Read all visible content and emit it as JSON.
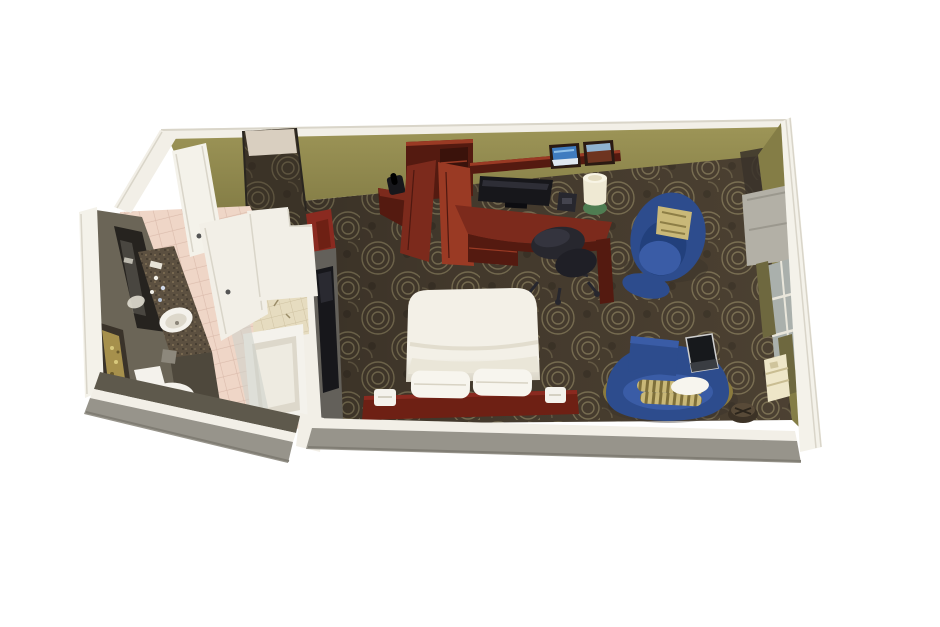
{
  "scene": {
    "title": "Hotel guest room 3D floor plan",
    "description": "Isometric cutaway dollhouse rendering of a hotel guest room with bedroom, entry vestibule and bathroom",
    "view": "top-down isometric cutaway",
    "rooms": [
      "bedroom",
      "bathroom",
      "entry-vestibule"
    ]
  },
  "inventory": {
    "bedroom": [
      "entry-door",
      "armoire-closet",
      "corner-phone-shelf",
      "telephone",
      "work-desk",
      "desk-chair",
      "flat-screen-tv",
      "wall-shelf",
      "framed-picture-beach",
      "framed-picture-landscape",
      "table-lamp",
      "alarm-clock",
      "queen-bed",
      "bed-pillows",
      "headboard",
      "bedside-sconces",
      "tub-armchair",
      "accent-pillow",
      "curved-sofa",
      "bolster-pillows",
      "laptop",
      "round-side-table",
      "window-with-curtains",
      "valance",
      "ptac-air-conditioner",
      "patterned-carpet",
      "tv-accent-wall"
    ],
    "bathroom": [
      "vanity-granite-counter",
      "sink",
      "mirror",
      "toiletries",
      "framed-artwork",
      "toilet",
      "bathtub",
      "tiled-shower-surround",
      "shower-curtain",
      "bathroom-door",
      "pink-tile-floor"
    ]
  },
  "palette": {
    "background": "#ffffff",
    "wall_olive": "#9d9557",
    "wall_olive_dark": "#847d46",
    "wall_cap_white": "#f2efe7",
    "wall_cap_edge": "#d9d5c9",
    "exterior_gray": "#97948b",
    "exterior_gray_dark": "#807d74",
    "exterior_white": "#f4f2ea",
    "carpet_base": "#4a3f31",
    "carpet_swirl": "#8d8260",
    "carpet_dark": "#352d23",
    "hallway_tile": "#d9cfc0",
    "tile_pink": "#eed3c3",
    "tile_grout": "#d8b6a5",
    "shower_tile": "#e6dcc0",
    "shower_grout": "#cfc2a2",
    "bath_wall_dark": "#6b6557",
    "bath_wall_darker": "#5e594c",
    "mirror_dark": "#26231f",
    "granite": "#5c5040",
    "granite_fleck": "#8a7a5c",
    "wood_cherry": "#7c2a1c",
    "wood_cherry_dark": "#541a10",
    "wood_cherry_light": "#9a3a24",
    "bed_white": "#f3f0e7",
    "pillow_white": "#f7f5ee",
    "bed_shadow": "#d8d3c4",
    "headboard_red": "#6e2014",
    "accent_red": "#8a2a20",
    "blue_upholstery": "#2d4c8d",
    "blue_dark": "#22407c",
    "blue_light": "#3a5ca6",
    "sofa_base_gold": "#8a7a3e",
    "bolster_gold": "#c9b878",
    "bolster_stripe": "#7e6f3a",
    "curtain_olive": "#6e683f",
    "valance_gray": "#b3b0a6",
    "window_glass": "#aab0ac",
    "window_frame": "#e9e6db",
    "ptac_cream": "#eee6c8",
    "tv_black": "#17171b",
    "chair_black": "#27272e",
    "lamp_shade": "#efe9d3",
    "lamp_base_green": "#4f7d52",
    "laptop_dark": "#17191c",
    "art_gold": "#a6904c",
    "fixture_white": "#f4f2ec",
    "fixture_shadow": "#ddd8cb",
    "shadow": "#3a332a"
  }
}
